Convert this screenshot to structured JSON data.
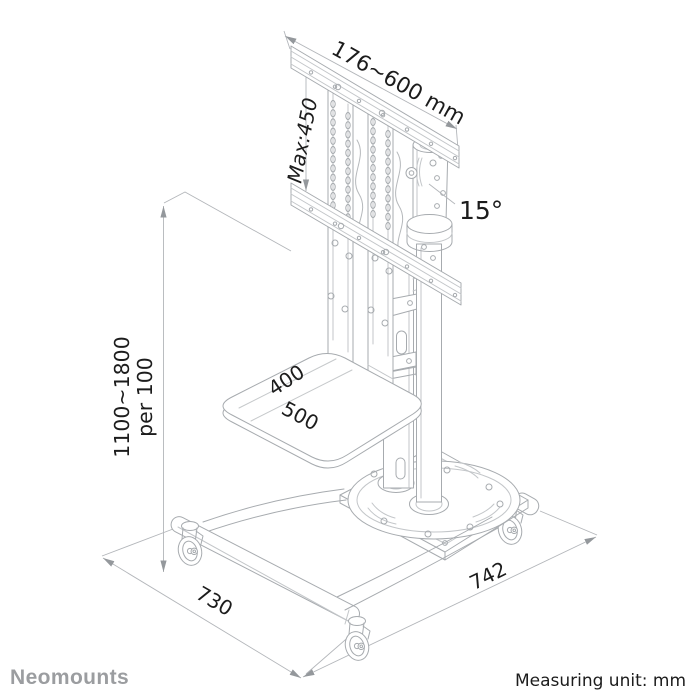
{
  "diagram": {
    "annotations": {
      "bracket_width_range": "176~600 mm",
      "bracket_max_height": "Max:450",
      "tilt_angle": "15°",
      "column_height_range": "1100~1800",
      "column_height_step": "per 100",
      "shelf_depth": "400",
      "shelf_width": "500",
      "base_depth": "730",
      "base_width": "742"
    }
  },
  "footer": {
    "brand": "Neomounts",
    "measuring_unit": "Measuring unit: mm"
  },
  "colors": {
    "background": "#ffffff",
    "drawing_line": "#a7abaf",
    "detail_line": "#c3c6c9",
    "dimension_line": "#b3b6ba",
    "arrow": "#94989c",
    "annotation_text": "#1c1c1c",
    "brand_text": "#9b9da0"
  }
}
